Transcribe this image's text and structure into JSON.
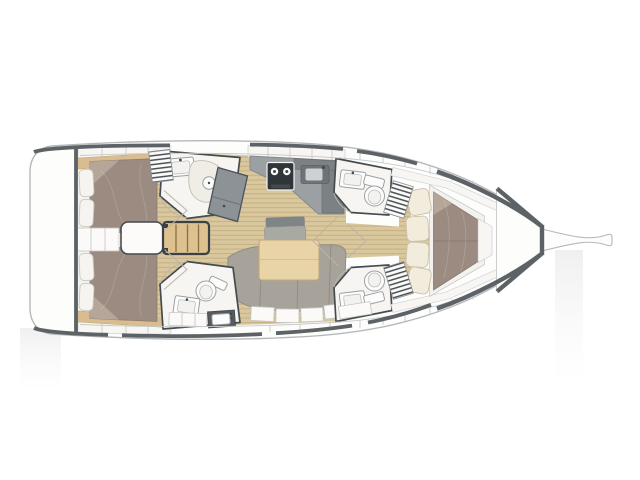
{
  "figure": {
    "type": "floorplan-diagram",
    "subject": "Sailing yacht interior layout plan, top view, bow to the right",
    "areas": [
      "swim-platform",
      "aft-port-cabin",
      "aft-starboard-cabin",
      "companionway-steps",
      "engine-hatch",
      "aft-port-head",
      "aft-starboard-head",
      "wet-locker",
      "galley",
      "salon",
      "forward-port-head",
      "forward-starboard-head",
      "forward-cabin",
      "anchor-locker",
      "bowsprit"
    ],
    "fixtures": [
      "double-berth",
      "v-berth",
      "pillows",
      "hull-cushions",
      "salon-table",
      "u-shaped-sofa",
      "bench-seat",
      "chaise-seat",
      "stove-2-burners",
      "galley-sink",
      "vanity-sinks",
      "toilets",
      "shower",
      "storage-drawers",
      "hull-shelves"
    ]
  },
  "colors": {
    "background": "#ffffff",
    "hull_fill": "#fdfdfc",
    "hull_line": "#b5b8ba",
    "deck_line": "#5d6266",
    "wall": "#464b4f",
    "liner": "#f7f6f3",
    "liner_line": "#c7c9cb",
    "cabin_bg": "#f3f2ee",
    "room": "#f6f5f2",
    "floor": "#d9c79d",
    "plank": "#c3ad80",
    "trim": "#d9bd90",
    "trim_line": "#c5a878",
    "bed": "#9b8b81",
    "bed_dark": "#8a7b70",
    "bed_fold": "#b5a698",
    "pillow": "#f6f4f0",
    "pillow_line": "#cbc7c0",
    "cushion": "#f2ecdc",
    "cushion_line": "#ccc2a9",
    "frame": "#f3f2ee",
    "frame_line": "#c9cbc9",
    "sofa": "#a7a39b",
    "sofa_line": "#8e8a82",
    "bench": "#a9a9a3",
    "bench_back": "#7f8486",
    "table": "#e8d4a6",
    "table_line": "#c2a878",
    "steps": "#ddc18f",
    "steps_line": "#3c4145",
    "tread": "#8a6f46",
    "counter": "#9ba0a3",
    "counter_dark": "#7b8184",
    "counter_edge": "#85898c",
    "stove": "#303539",
    "burner": "#fafafa",
    "sink_dark": "#6d7376",
    "basin": "#cdd1d3",
    "fixture": "#fcfcfb",
    "fixture_line": "#9aa0a3",
    "fixture_inner": "#f3f2ef",
    "shower": "#f0ede7",
    "shower_line": "#c2bdb3",
    "locker": "#8d9296",
    "locker_line": "#4c5155",
    "hatch_line": "#4a4f53",
    "door_line": "#bab4aa",
    "dark_counter": "#565b5f",
    "shadow": "#eeeeee"
  }
}
